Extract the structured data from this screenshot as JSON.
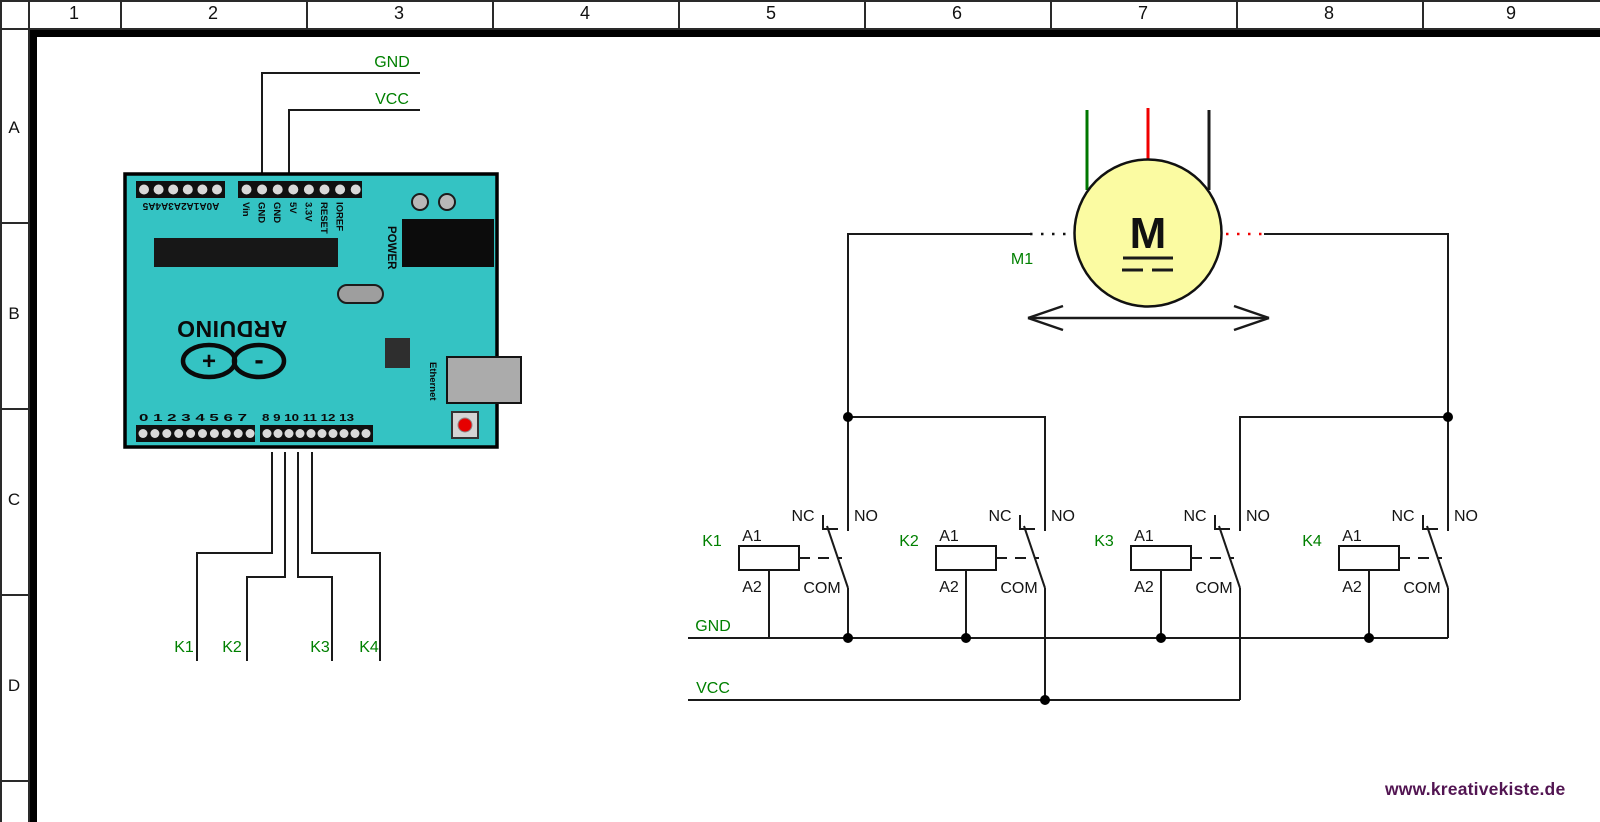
{
  "frame": {
    "columns": [
      "1",
      "2",
      "3",
      "4",
      "5",
      "6",
      "7",
      "8",
      "9"
    ],
    "rows": [
      "A",
      "B",
      "C",
      "D"
    ]
  },
  "arduino": {
    "board_color": "#34c3c3",
    "brand": "ARDUINO",
    "logo_plus": "+",
    "logo_minus": "-",
    "analog_row_label": "A0A1A2A3A4A5",
    "power_pin_labels": [
      "Vin",
      "GND",
      "GND",
      "5V",
      "3.3V",
      "RESET",
      "IOREF"
    ],
    "power_label": "POWER",
    "ethernet_label": "Ethernet",
    "digital_left": "0 1 2 3 4 5 6 7",
    "digital_right": "8 9 10 11 12 13",
    "gnd_wire_label": "GND",
    "vcc_wire_label": "VCC",
    "output_wire_labels": [
      "K1",
      "K2",
      "K3",
      "K4"
    ]
  },
  "motor": {
    "designator": "M1",
    "symbol": "M"
  },
  "relays": [
    {
      "name": "K1",
      "coil_top": "A1",
      "coil_bottom": "A2",
      "nc": "NC",
      "no": "NO",
      "com": "COM"
    },
    {
      "name": "K2",
      "coil_top": "A1",
      "coil_bottom": "A2",
      "nc": "NC",
      "no": "NO",
      "com": "COM"
    },
    {
      "name": "K3",
      "coil_top": "A1",
      "coil_bottom": "A2",
      "nc": "NC",
      "no": "NO",
      "com": "COM"
    },
    {
      "name": "K4",
      "coil_top": "A1",
      "coil_bottom": "A2",
      "nc": "NC",
      "no": "NO",
      "com": "COM"
    }
  ],
  "rails": {
    "gnd_label": "GND",
    "vcc_label": "VCC"
  },
  "watermark": {
    "text": "www.kreativekiste.de",
    "color": "#521552"
  },
  "colors": {
    "label_green": "#008000",
    "wire_green": "#007700",
    "wire_red": "#f00000",
    "motor_yellow": "#fbfba2",
    "board_teal": "#34c3c3"
  }
}
